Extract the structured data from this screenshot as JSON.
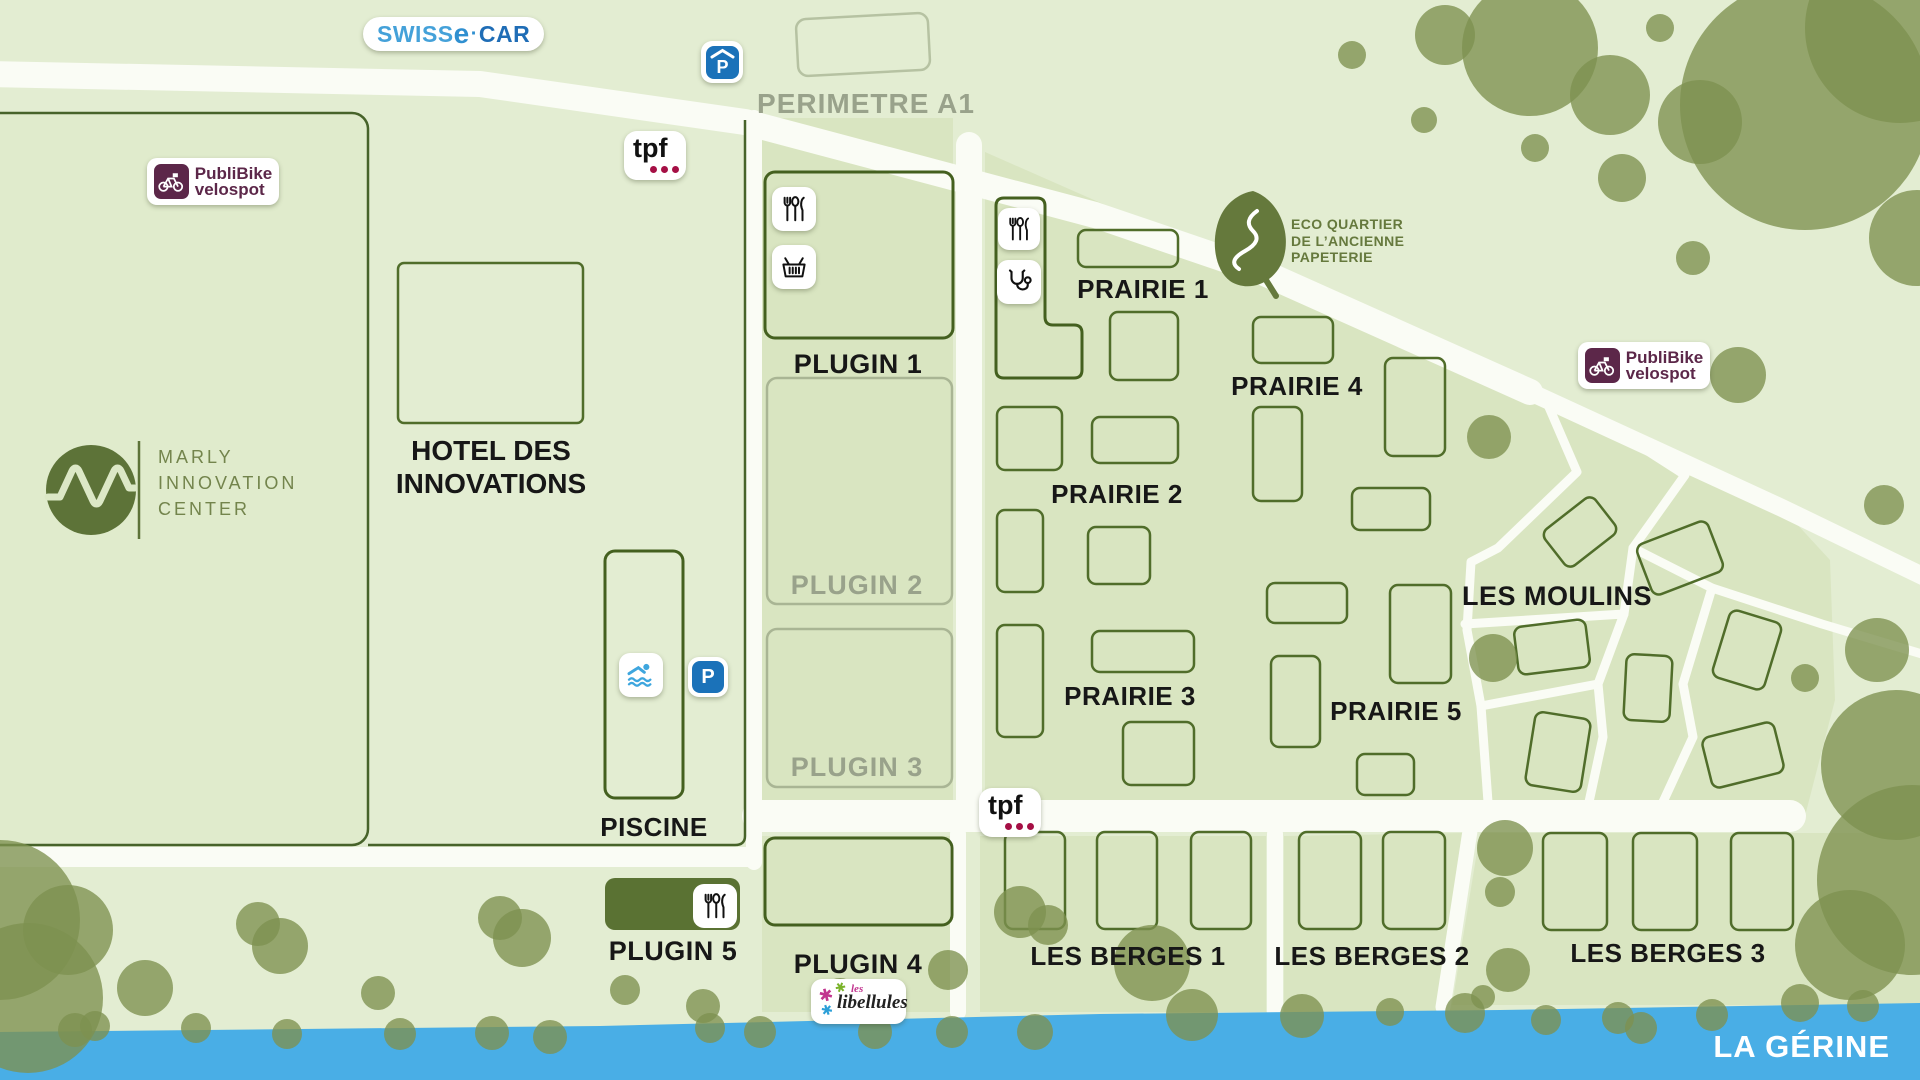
{
  "logos": {
    "swiss_ecar": {
      "swiss": "SWISS",
      "e": "e",
      "dot": "·",
      "car": "CAR"
    },
    "publibike": {
      "line1": "PubliBike",
      "line2": "velospot"
    },
    "tpf": {
      "text": "tpf"
    },
    "mic": {
      "line1": "MARLY",
      "line2": "INNOVATION",
      "line3": "CENTER"
    },
    "eco": {
      "line1": "ECO QUARTIER",
      "line2": "DE L’ANCIENNE",
      "line3": "PAPETERIE"
    },
    "libellules": {
      "les": "les",
      "name": "libellules"
    }
  },
  "zones": {
    "perimetre_a1": "PERIMETRE A1",
    "hotel": {
      "line1": "HOTEL DES",
      "line2": "INNOVATIONS"
    },
    "piscine": "PISCINE",
    "plugin1": "PLUGIN 1",
    "plugin2": "PLUGIN 2",
    "plugin3": "PLUGIN 3",
    "plugin4": "PLUGIN 4",
    "plugin5": "PLUGIN 5",
    "prairie1": "PRAIRIE 1",
    "prairie2": "PRAIRIE 2",
    "prairie3": "PRAIRIE 3",
    "prairie4": "PRAIRIE 4",
    "prairie5": "PRAIRIE 5",
    "les_moulins": "LES MOULINS",
    "les_berges1": "LES BERGES 1",
    "les_berges2": "LES BERGES 2",
    "les_berges3": "LES BERGES 3"
  },
  "river": {
    "name": "LA GÉRINE"
  },
  "icons": {
    "parking_letter": "P",
    "names": [
      "restaurant-icon",
      "shop-basket-icon",
      "medical-icon",
      "swimmer-icon",
      "covered-parking-icon",
      "parking-icon",
      "bike-icon",
      "leaf-icon",
      "dragonfly-icon"
    ]
  },
  "colors": {
    "background": "#e3edd2",
    "panel": "#d9e5c1",
    "road": "#fafcf5",
    "river": "#49aee6",
    "tree": "#7d9150",
    "outline_dark": "#47632a",
    "outline_light": "#a9b594",
    "dark_olive_fill": "#5a7233",
    "publibike_purple": "#5c2749",
    "parking_blue": "#1b72b9",
    "tpf_crimson": "#a50f45",
    "grey_label": "#99a28b",
    "eco_green": "#66793d"
  }
}
